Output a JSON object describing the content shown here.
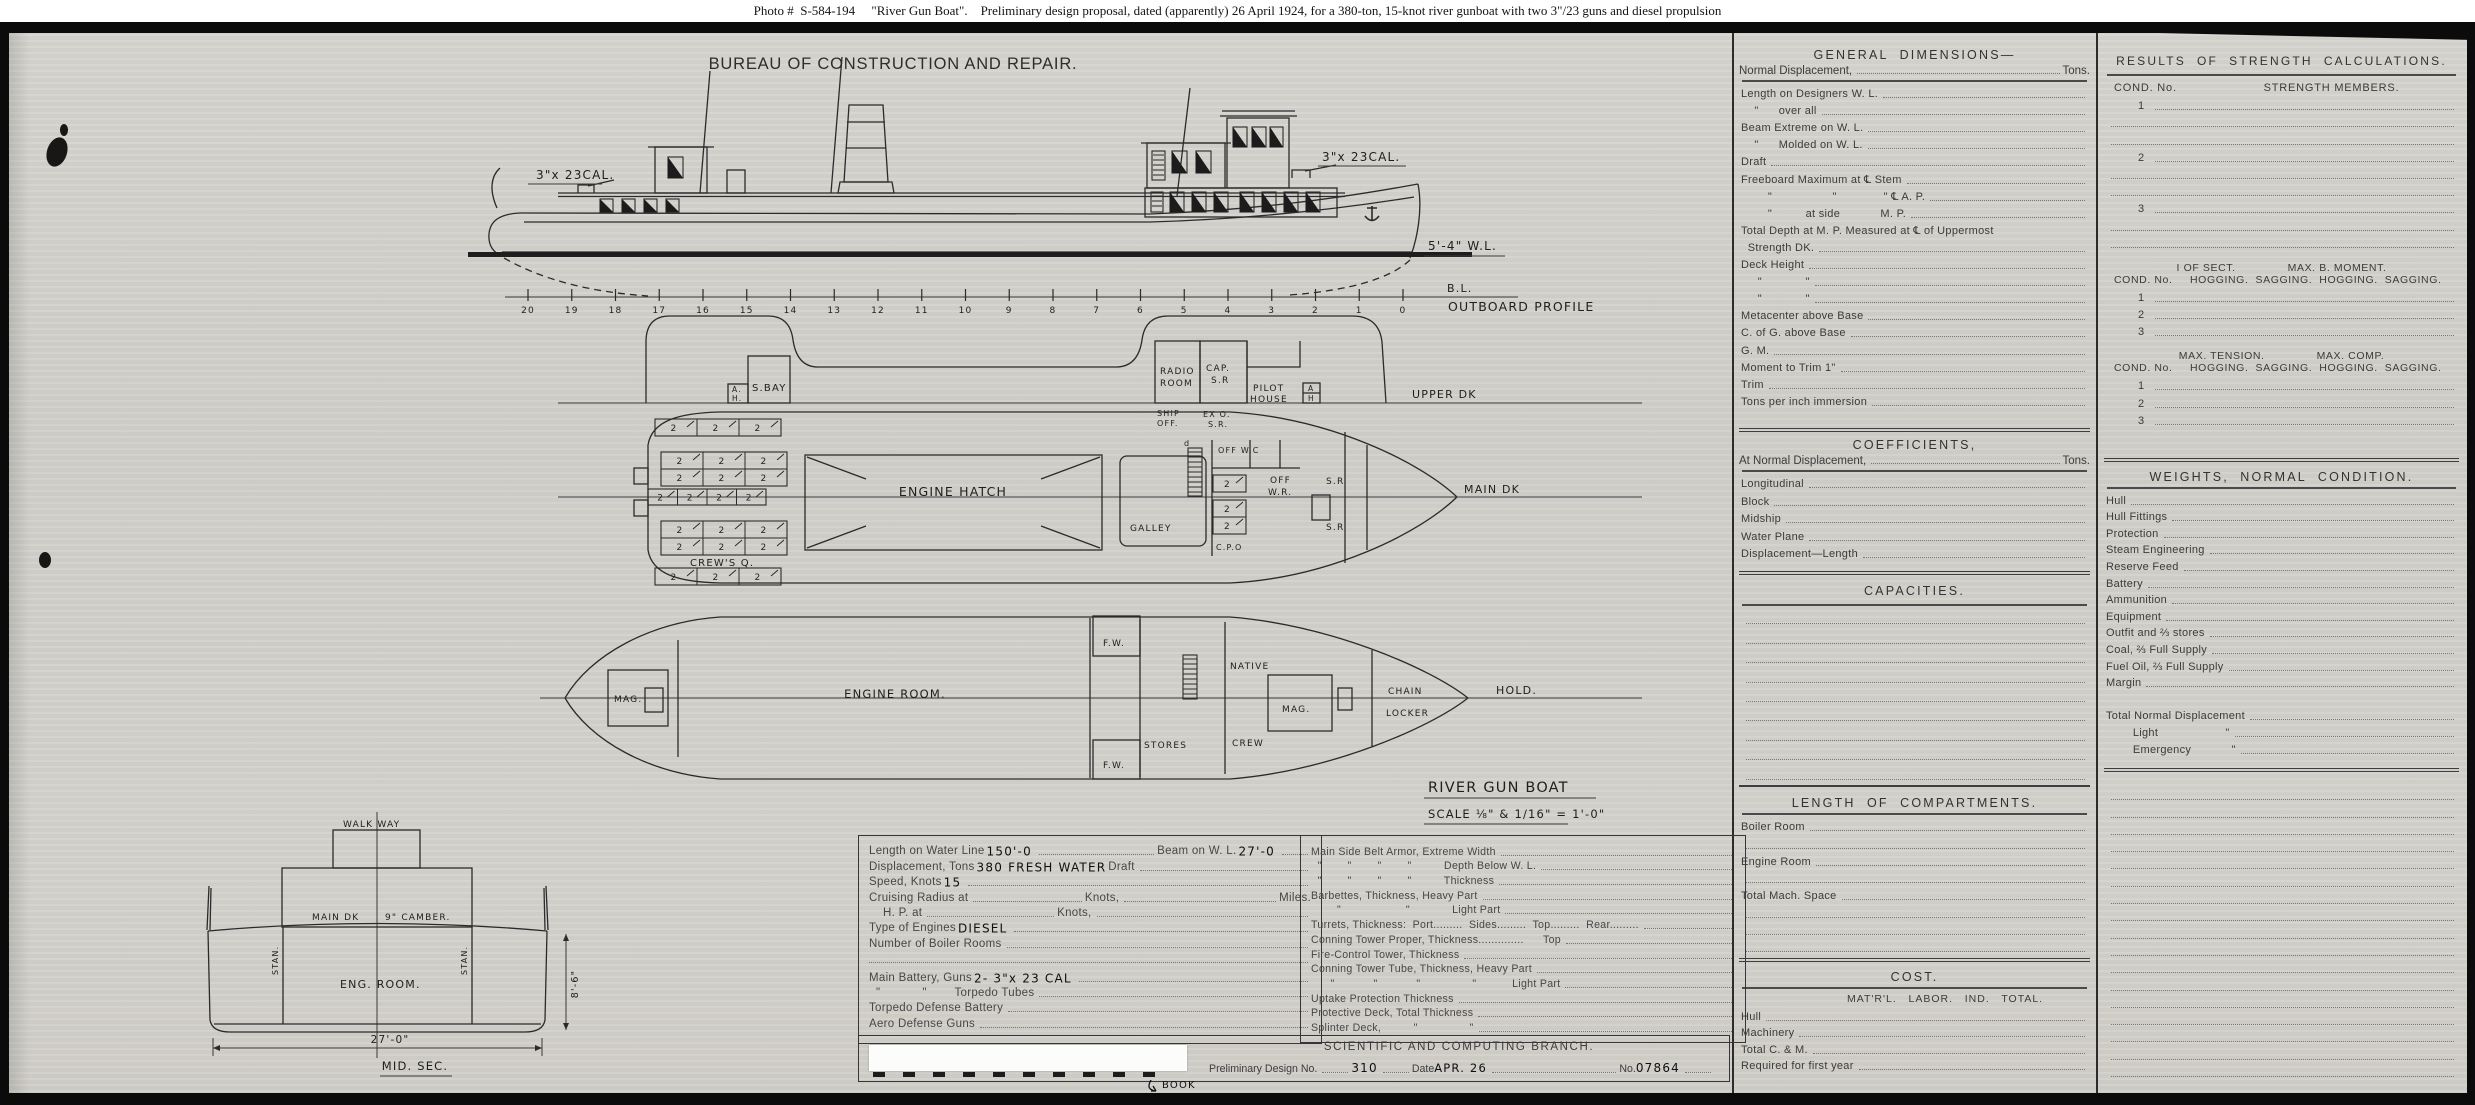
{
  "colors": {
    "paper": "#d3d1cb",
    "ink": "#2b2b2b",
    "caption_bg": "#ffffff",
    "waterline": "#1e1e1e"
  },
  "caption": "Photo #  S-584-194     \"River Gun Boat\".    Preliminary design proposal, dated (apparently) 26 April 1924, for a 380-ton, 15-knot river gunboat with two 3\"/23 guns and diesel propulsion",
  "drawing": {
    "bureau_title": "BUREAU  OF  CONSTRUCTION  AND  REPAIR.",
    "profile": {
      "view_label": "OUTBOARD PROFILE",
      "baseline_label": "B.L.",
      "waterline_label": "5'-4\" W.L.",
      "aft_gun_label": "3\"x 23CAL.",
      "fwd_gun_label": "3\"x 23CAL.",
      "stations": [
        "20",
        "19",
        "18",
        "17",
        "16",
        "15",
        "14",
        "13",
        "12",
        "11",
        "10",
        "9",
        "8",
        "7",
        "6",
        "5",
        "4",
        "3",
        "2",
        "1",
        "0"
      ],
      "windows": [
        {
          "x": 600,
          "y": 199,
          "w": 13,
          "h": 13,
          "t": "d"
        },
        {
          "x": 622,
          "y": 199,
          "w": 13,
          "h": 13,
          "t": "d"
        },
        {
          "x": 644,
          "y": 199,
          "w": 13,
          "h": 13,
          "t": "d"
        },
        {
          "x": 666,
          "y": 199,
          "w": 13,
          "h": 13,
          "t": "d"
        },
        {
          "x": 668,
          "y": 157,
          "w": 15,
          "h": 21,
          "t": "d"
        },
        {
          "x": 1152,
          "y": 151,
          "w": 13,
          "h": 29,
          "t": "h"
        },
        {
          "x": 1172,
          "y": 151,
          "w": 15,
          "h": 22,
          "t": "d"
        },
        {
          "x": 1196,
          "y": 151,
          "w": 15,
          "h": 22,
          "t": "d"
        },
        {
          "x": 1233,
          "y": 127,
          "w": 14,
          "h": 20,
          "t": "d"
        },
        {
          "x": 1252,
          "y": 127,
          "w": 14,
          "h": 20,
          "t": "d"
        },
        {
          "x": 1270,
          "y": 127,
          "w": 13,
          "h": 20,
          "t": "d"
        },
        {
          "x": 1151,
          "y": 192,
          "w": 12,
          "h": 20,
          "t": "h"
        },
        {
          "x": 1170,
          "y": 192,
          "w": 14,
          "h": 20,
          "t": "d"
        },
        {
          "x": 1192,
          "y": 192,
          "w": 14,
          "h": 20,
          "t": "d"
        },
        {
          "x": 1214,
          "y": 192,
          "w": 14,
          "h": 20,
          "t": "d"
        },
        {
          "x": 1240,
          "y": 192,
          "w": 14,
          "h": 20,
          "t": "d"
        },
        {
          "x": 1262,
          "y": 192,
          "w": 14,
          "h": 20,
          "t": "d"
        },
        {
          "x": 1284,
          "y": 192,
          "w": 14,
          "h": 20,
          "t": "d"
        },
        {
          "x": 1306,
          "y": 192,
          "w": 14,
          "h": 20,
          "t": "d"
        }
      ]
    },
    "upper_deck": {
      "deck_label": "UPPER DK",
      "sbay": "S.BAY",
      "ah_top": "A.",
      "ah_bottom": "H.",
      "radio_1": "RADIO",
      "radio_2": "ROOM",
      "ship_off_1": "SHIP",
      "ship_off_2": "OFF.",
      "cap_1": "CAP.",
      "cap_2": "S.R",
      "exo_1": "EX O.",
      "exo_2": "S.R.",
      "pilot_1": "PILOT",
      "pilot_2": "HOUSE",
      "ah2_top": "A",
      "ah2_bottom": "H"
    },
    "main_deck": {
      "deck_label": "MAIN DK",
      "engine_hatch": "ENGINE HATCH",
      "crews_q": "CREW'S Q.",
      "galley": "GALLEY",
      "ladder": "d",
      "off_wc": "OFF W.C",
      "off_1": "OFF",
      "off_2": "W.R.",
      "sr_top": "S.R",
      "sr_bot": "S.R",
      "cpo": "C.P.O",
      "berth": "2",
      "berth_groups": [
        {
          "x": 655,
          "y": 419,
          "w": 126,
          "h": 17,
          "cols": 3,
          "rows": 1
        },
        {
          "x": 661,
          "y": 452,
          "w": 126,
          "h": 34,
          "cols": 3,
          "rows": 2
        },
        {
          "x": 648,
          "y": 489,
          "w": 118,
          "h": 16,
          "cols": 4,
          "rows": 1
        },
        {
          "x": 661,
          "y": 521,
          "w": 126,
          "h": 34,
          "cols": 3,
          "rows": 2
        },
        {
          "x": 655,
          "y": 568,
          "w": 126,
          "h": 17,
          "cols": 3,
          "rows": 1
        },
        {
          "x": 1213,
          "y": 475,
          "w": 33,
          "h": 17,
          "cols": 1,
          "rows": 1
        },
        {
          "x": 1213,
          "y": 500,
          "w": 33,
          "h": 34,
          "cols": 1,
          "rows": 2
        }
      ]
    },
    "hold": {
      "deck_label": "HOLD.",
      "mag_aft": "MAG.",
      "engine_room": "ENGINE ROOM.",
      "fw_top": "F.W.",
      "fw_bot": "F.W.",
      "stores": "STORES",
      "native": "NATIVE",
      "mag_fwd": "MAG.",
      "crew": "CREW",
      "chain_1": "CHAIN",
      "chain_2": "LOCKER"
    },
    "title_block": {
      "name": "RIVER GUN BOAT",
      "scale": "SCALE ⅛\" & 1/16\" = 1'-0\""
    },
    "midship": {
      "walkway": "WALK WAY",
      "main_dk": "MAIN DK",
      "camber": "9\" CAMBER.",
      "stan_left": "STAN.",
      "stan_right": "STAN.",
      "eng_room": "ENG. ROOM.",
      "depth_dim": "8'-6\"",
      "beam_dim": "27'-0\"",
      "label": "MID. SEC."
    }
  },
  "specs": {
    "left": {
      "r1a": "Length on Water Line",
      "r1v": "150'-0",
      "r1b": "Beam on W. L.",
      "r1v2": "27'-0",
      "r2a": "Displacement, Tons",
      "r2v": "380 FRESH WATER",
      "r2b": "Draft",
      "r3a": "Speed, Knots",
      "r3v": "15",
      "r4a": "Cruising Radius at",
      "r4b": "Knots,",
      "r4c": "Miles.",
      "r5a": "H. P. at",
      "r5b": "Knots,",
      "r6a": "Type of Engines",
      "r6v": "DIESEL",
      "r7a": "Number of Boiler Rooms",
      "r9a": "Main Battery, Guns",
      "r9v": "2- 3\"x 23 CAL",
      "r10a": "  \"            \"        Torpedo Tubes",
      "r11a": "Torpedo Defense Battery",
      "r12a": "Aero Defense Guns"
    },
    "armor_rows": [
      "Main Side Belt Armor, Extreme Width",
      "  \"        \"        \"        \"          Depth Below W. L.",
      "  \"        \"        \"        \"          Thickness",
      "Barbettes, Thickness, Heavy Part",
      "        \"                    \"             Light Part",
      "Turrets, Thickness:  Port.........  Sides.........  Top.........  Rear.........",
      "Conning Tower Proper, Thickness..............      Top",
      "Fire-Control Tower, Thickness",
      "Conning Tower Tube, Thickness, Heavy Part",
      "      \"            \"            \"                \"           Light Part",
      "Uptake Protection Thickness",
      "Protective Deck, Total Thickness",
      "Splinter Deck,          \"                \""
    ],
    "footer": {
      "branch": "SCIENTIFIC AND COMPUTING BRANCH.",
      "prelim_label": "Preliminary Design No.",
      "prelim_value": "310",
      "date_label": "Date",
      "date_value": "APR. 26",
      "no_label": "No.",
      "no_value": "07864",
      "book_note": "BOOK"
    }
  },
  "panels": {
    "general_dimensions": {
      "title": "GENERAL  DIMENSIONS—",
      "sub_label": "Normal  Displacement,",
      "sub_unit": "Tons.",
      "rows": [
        "Length on Designers W. L.",
        "    \"      over all",
        "Beam Extreme on W. L.",
        "    \"      Molded on W. L.",
        "Draft",
        "Freeboard Maximum at ℄ Stem",
        "        \"                  \"              \" ℄ A. P.",
        "        \"          at side            M. P.",
        "!Total Depth at M. P. Measured at ℄ of Uppermost",
        "  Strength DK.",
        "Deck Height",
        "     \"             \"",
        "     \"             \"",
        "Metacenter above Base",
        "C. of G. above Base",
        "G. M.",
        "Moment to Trim 1\"",
        "Trim",
        "Tons per inch immersion"
      ]
    },
    "coefficients": {
      "title": "COEFFICIENTS,",
      "sub_label": "At  Normal  Displacement,",
      "sub_unit": "Tons.",
      "rows": [
        "Longitudinal",
        "Block",
        "Midship",
        "Water Plane",
        "Displacement—Length"
      ]
    },
    "capacities": {
      "title": "CAPACITIES.",
      "rows": [
        "",
        "",
        "",
        "",
        "",
        "",
        "",
        "",
        ""
      ]
    },
    "compartments": {
      "title": "LENGTH  OF  COMPARTMENTS.",
      "rows": [
        "Boiler Room",
        "",
        "Engine Room",
        "",
        "Total Mach. Space",
        "",
        "",
        ""
      ]
    },
    "cost": {
      "title": "COST.",
      "columns": "MAT'R'L.   LABOR.   IND.   TOTAL.",
      "rows": [
        "Hull",
        "Machinery",
        "Total C. & M.",
        "Required for first year"
      ]
    },
    "strength": {
      "title": "RESULTS  OF  STRENGTH  CALCULATIONS.",
      "cond_label": "COND. No.",
      "members_label": "STRENGTH  MEMBERS.",
      "member_rows": [
        "1",
        "",
        "",
        "2",
        "",
        "",
        "3",
        "",
        ""
      ],
      "sect_label": "I OF SECT.",
      "moment_label": "MAX. B. MOMENT.",
      "hog_sag": "HOGGING.  SAGGING.  HOGGING.  SAGGING.",
      "sect_rows": [
        "1",
        "2",
        "3"
      ],
      "tension_label": "MAX. TENSION.",
      "comp_label": "MAX. COMP.",
      "tension_rows": [
        "1",
        "2",
        "3"
      ]
    },
    "weights": {
      "title": "WEIGHTS,  NORMAL  CONDITION.",
      "rows": [
        "Hull",
        "Hull Fittings",
        "Protection",
        "Steam Engineering",
        "Reserve Feed",
        "Battery",
        "Ammunition",
        "Equipment",
        "Outfit and ⅔ stores",
        "Coal, ⅔ Full Supply",
        "Fuel Oil, ⅔ Full Supply",
        "Margin",
        "~",
        "Total Normal Displacement",
        "        Light                    \"",
        "        Emergency            \""
      ]
    },
    "notes": {
      "rows": [
        "",
        "",
        "",
        "",
        "",
        "",
        "",
        "",
        "",
        "",
        "",
        "",
        "",
        "",
        "",
        "",
        ""
      ]
    }
  }
}
